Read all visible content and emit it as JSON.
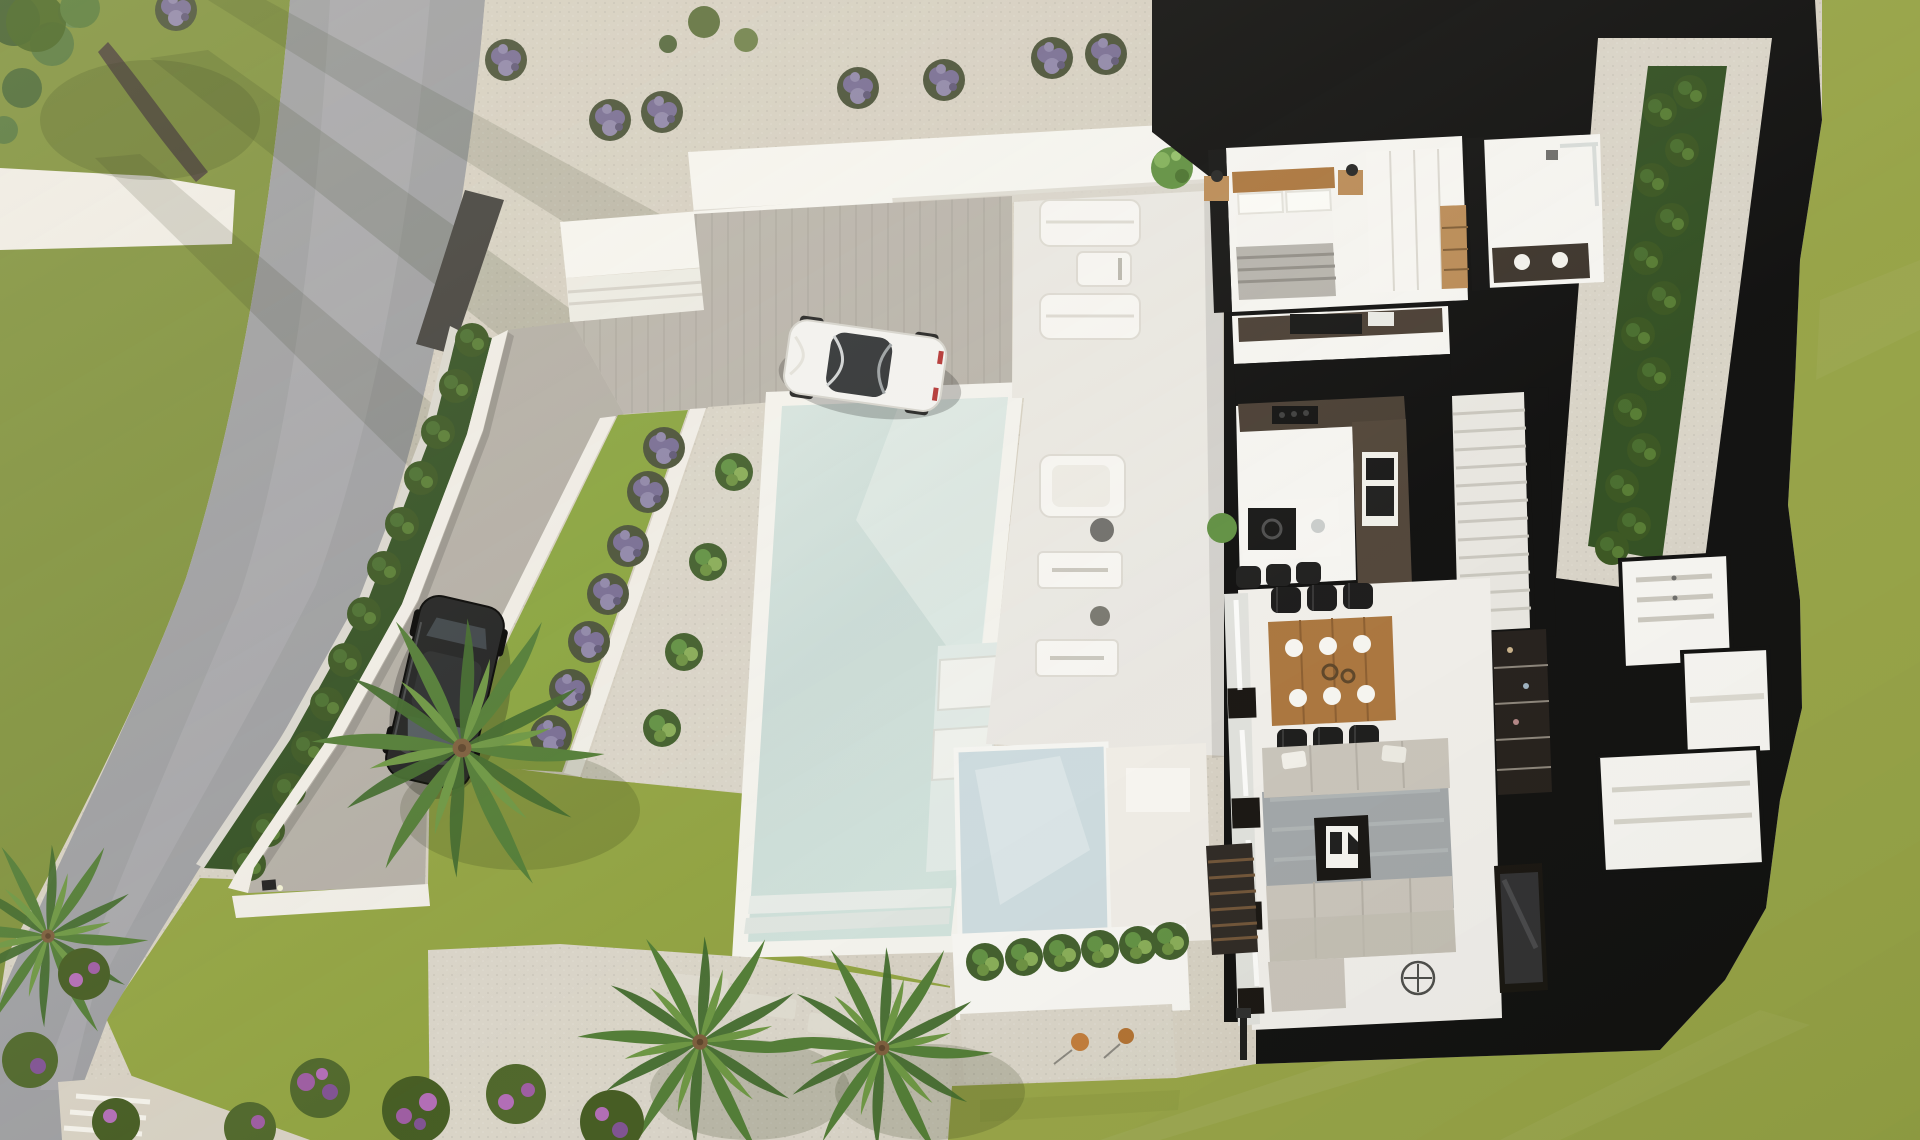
{
  "scene": {
    "type": "aerial-3d-architectural-render",
    "subject": "modern villa top-down cutaway floor plan with pool, driveway, two cars and landscaped gardens",
    "objects": [
      {
        "name": "public-road",
        "count": 1
      },
      {
        "name": "black-car",
        "count": 1
      },
      {
        "name": "white-sports-car",
        "count": 1
      },
      {
        "name": "swimming-pool",
        "count": 1
      },
      {
        "name": "in-pool-loungers",
        "count": 2
      },
      {
        "name": "deck-loungers",
        "count": 2
      },
      {
        "name": "lavender-bushes-row",
        "count": 8
      },
      {
        "name": "boundary-hedge",
        "count": 2
      },
      {
        "name": "palm-trees",
        "count": 4
      },
      {
        "name": "bedroom-double-bed",
        "count": 1
      },
      {
        "name": "kitchen-island-stools",
        "count": 3
      },
      {
        "name": "dining-chairs",
        "count": 6
      },
      {
        "name": "dining-table-place-settings",
        "count": 6
      },
      {
        "name": "living-room-sofa-sections",
        "count": 3
      },
      {
        "name": "entrance-planter-shrubs",
        "count": 6
      }
    ]
  },
  "palette": {
    "page_bg": "#cfc9bd",
    "road": "#9b9ca0",
    "grass_nw": "#7d8f3a",
    "grass_front": "#8fa13f",
    "grass_right": "#95a245",
    "grass_tier": "#87a23c",
    "gravel": "#d5cfc2",
    "gravel2": "#d8d3c7",
    "hedge": "#2f4d20",
    "hedge_leaf": "#466b2c",
    "wall_white": "#efece6",
    "terrace_white": "#f5f4f0",
    "deck": "#e9e7e2",
    "pool_coping": "#f3f2ed",
    "pool_water": "#ccdcd9",
    "pool_water_light": "#dfe9e5",
    "glass_frost": "#ccdade",
    "roof_black": "#0d0d0d",
    "wall_dark": "#3f3d3a",
    "floor_int": "#f5f4f1",
    "counter_dark": "#473c32",
    "wood": "#a9743c",
    "wood_light": "#b98a55",
    "sofa": "#c8c3ba",
    "rug": "#a0a5a8",
    "chair_black": "#181818",
    "car_white": "#f2f2f0",
    "car_black": "#1d1e1f",
    "palm": "#4f7a33",
    "palm_light": "#6a9440",
    "lavender": "#756a92",
    "lavender_dark": "#474f36",
    "shrub": "#5f8f41",
    "flower_purple": "#9b59a0",
    "orange_plant": "#c07a38"
  }
}
